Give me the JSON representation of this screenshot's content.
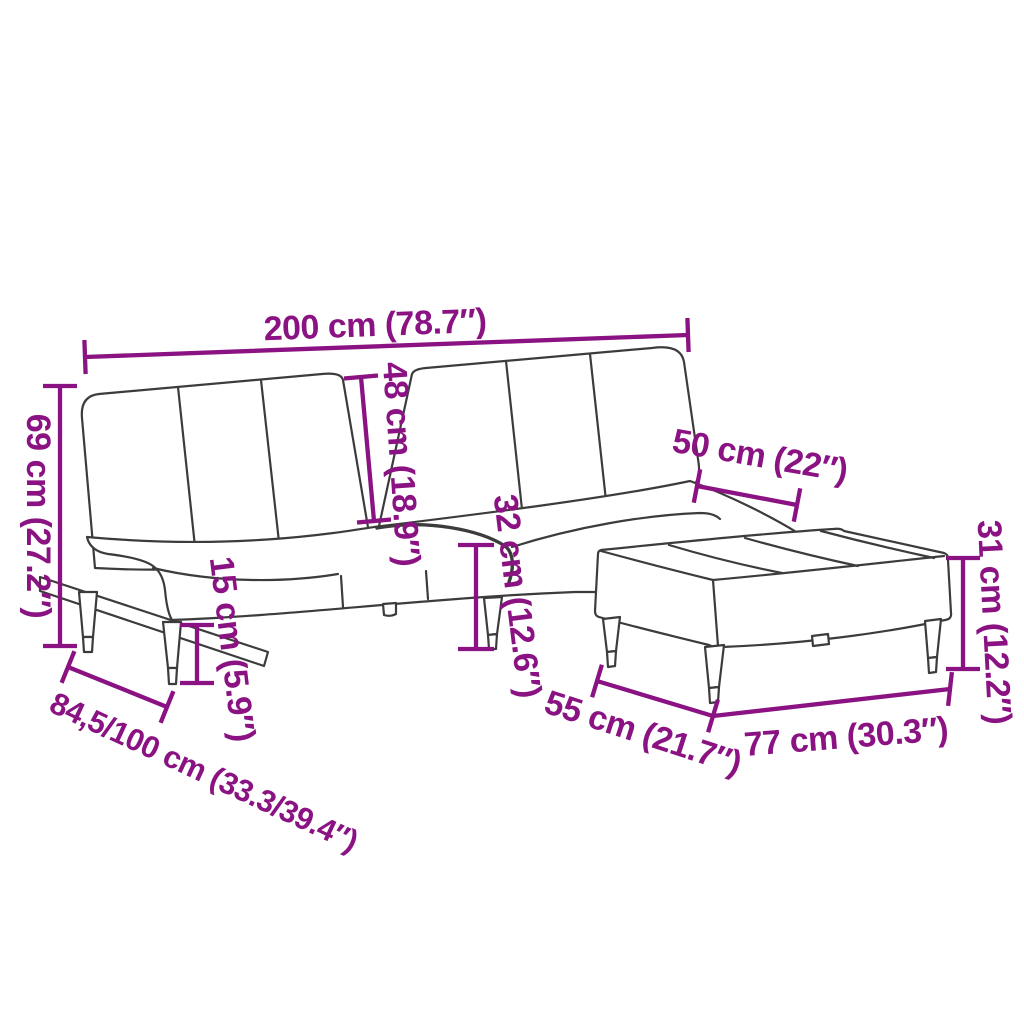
{
  "diagram": {
    "kind": "product-dimension-diagram",
    "subject": "sofa-bed-with-footstool",
    "colors": {
      "dimension": "#8A1282",
      "outline": "#3C3C3C",
      "background": "#FFFFFF"
    },
    "dimensions": {
      "overall_width": "200 cm (78.7″)",
      "overall_height": "69 cm (27.2″)",
      "backrest_height": "48 cm (18.9″)",
      "leg_height": "15 cm (5.9″)",
      "seat_height": "32 cm (12.6″)",
      "seat_depth": "50 cm (22″)",
      "sofa_depth": "84,5/100 cm (33.3/39.4″)",
      "footstool_height": "31 cm (12.2″)",
      "footstool_depth": "55 cm (21.7″)",
      "footstool_width": "77 cm (30.3″)"
    }
  }
}
